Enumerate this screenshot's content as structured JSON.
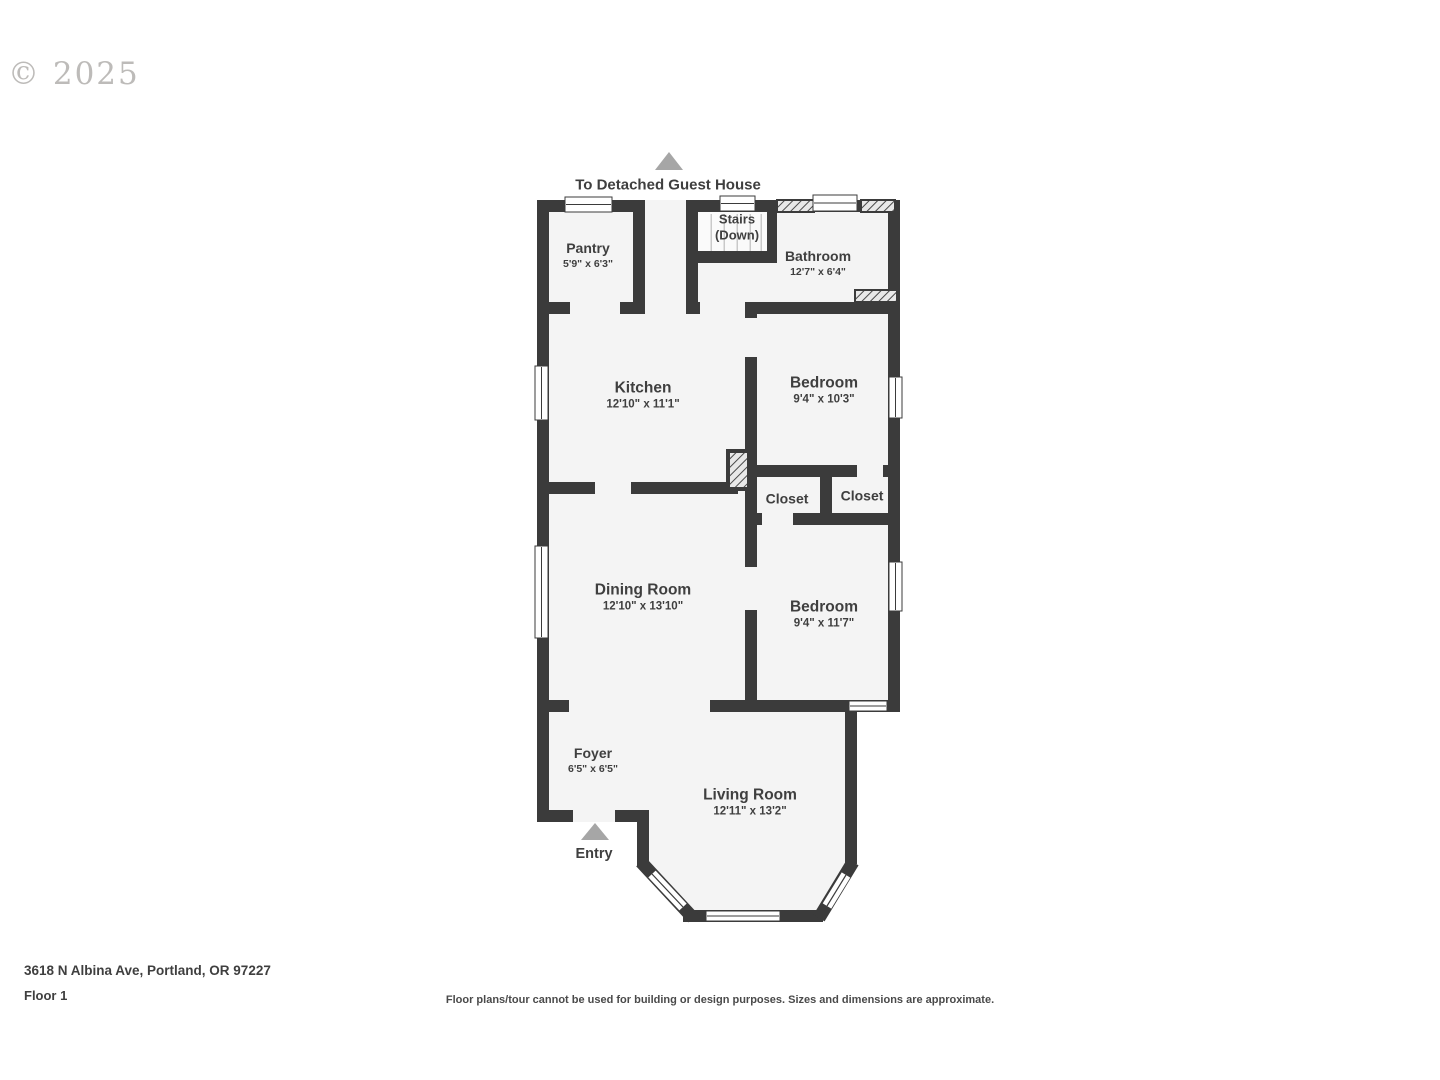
{
  "watermark": "© 2025",
  "annotations": {
    "guest_house": "To Detached Guest House",
    "entry": "Entry",
    "stairs_line1": "Stairs",
    "stairs_line2": "(Down)"
  },
  "rooms": [
    {
      "name": "Pantry",
      "dims": "5'9\" x 6'3\""
    },
    {
      "name": "Bathroom",
      "dims": "12'7\" x 6'4\""
    },
    {
      "name": "Kitchen",
      "dims": "12'10\" x 11'1\""
    },
    {
      "name": "Bedroom",
      "dims": "9'4\" x 10'3\""
    },
    {
      "name": "Closet",
      "dims": ""
    },
    {
      "name": "Closet",
      "dims": ""
    },
    {
      "name": "Dining Room",
      "dims": "12'10\" x 13'10\""
    },
    {
      "name": "Bedroom",
      "dims": "9'4\" x 11'7\""
    },
    {
      "name": "Foyer",
      "dims": "6'5\" x 6'5\""
    },
    {
      "name": "Living Room",
      "dims": "12'11\" x 13'2\""
    }
  ],
  "footer": {
    "address": "3618 N Albina Ave, Portland, OR 97227",
    "floor": "Floor 1",
    "disclaimer": "Floor plans/tour cannot be used for building or design purposes. Sizes and dimensions are approximate."
  },
  "colors": {
    "wall": "#3b3b3b",
    "room_fill": "#f4f4f4",
    "stairs_fill": "#fafafa",
    "window": "#ffffff",
    "arrow": "#a6a6a6",
    "text": "#3f3f3f",
    "watermark": "#b2b0ad"
  }
}
